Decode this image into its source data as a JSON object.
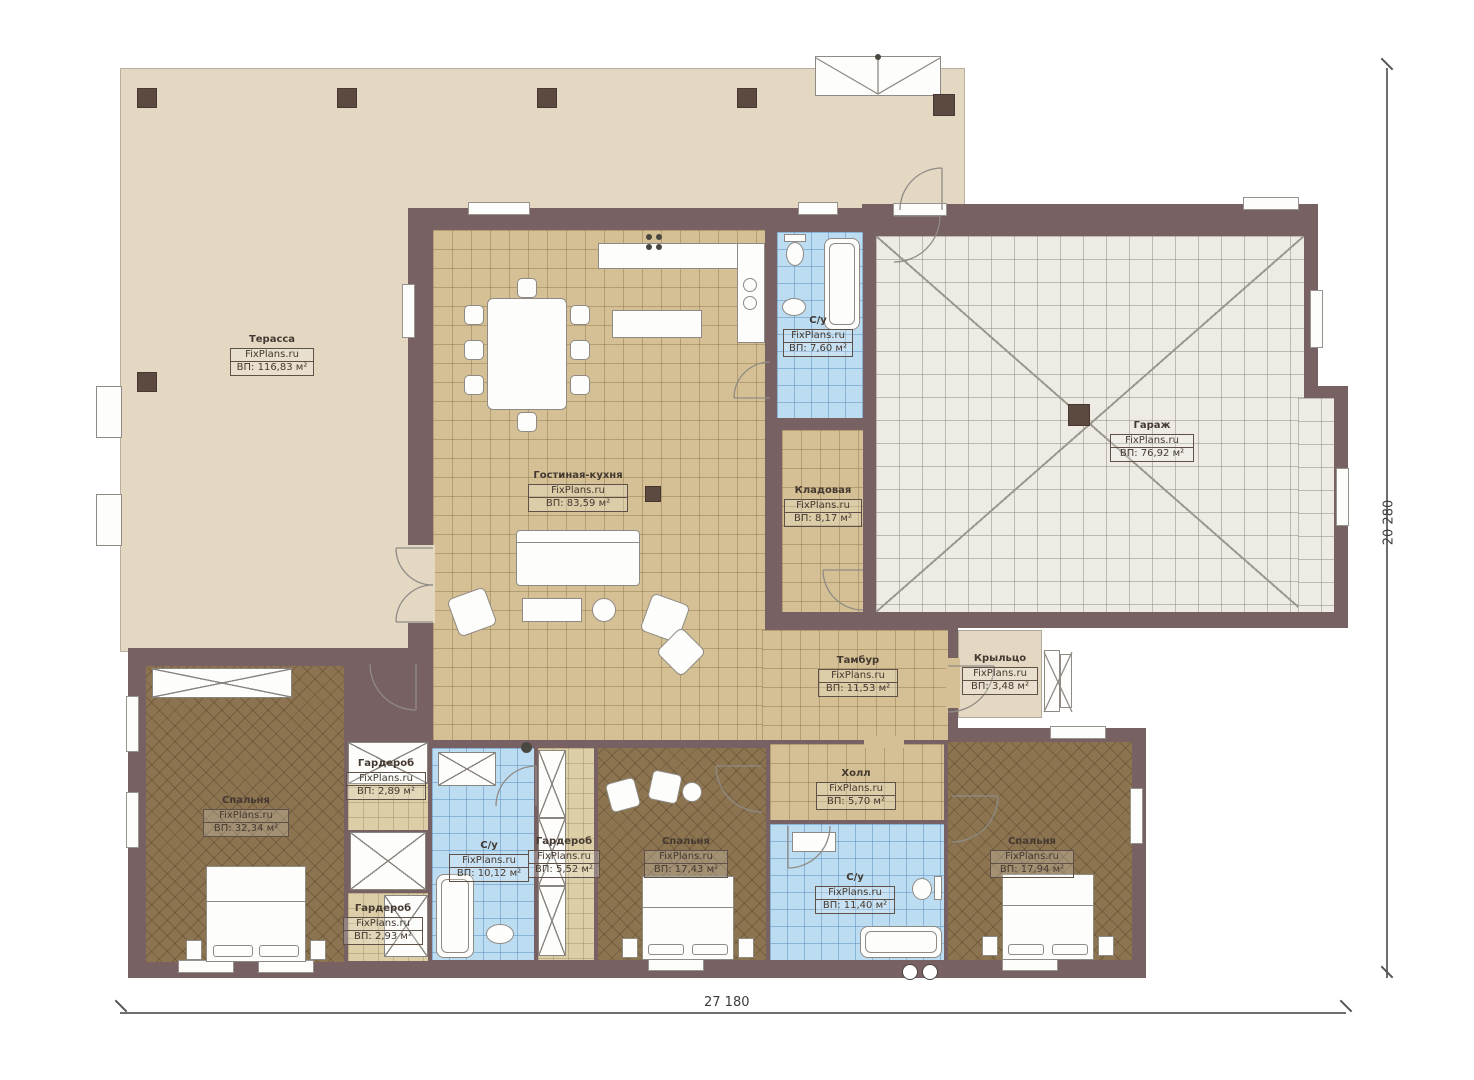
{
  "meta": {
    "site": "FixPlans.ru"
  },
  "dimensions": {
    "width": "27 180",
    "height": "20 280"
  },
  "rooms": {
    "terrace": {
      "name": "Терасса",
      "area": "ВП: 116,83 м²"
    },
    "living": {
      "name": "Гостиная-кухня",
      "area": "ВП: 83,59 м²"
    },
    "bath_top": {
      "name": "С/у",
      "area": "ВП: 7,60 м²"
    },
    "storage": {
      "name": "Кладовая",
      "area": "ВП: 8,17 м²"
    },
    "garage": {
      "name": "Гараж",
      "area": "ВП: 76,92 м²"
    },
    "tambour": {
      "name": "Тамбур",
      "area": "ВП: 11,53 м²"
    },
    "porch": {
      "name": "Крыльцо",
      "area": "ВП: 3,48 м²"
    },
    "bedroom_left": {
      "name": "Спальня",
      "area": "ВП: 32,34 м²"
    },
    "wardrobe_top": {
      "name": "Гардероб",
      "area": "ВП: 2,89 м²"
    },
    "wardrobe_bottom": {
      "name": "Гардероб",
      "area": "ВП: 2,93 м²"
    },
    "bath_left": {
      "name": "С/у",
      "area": "ВП: 10,12 м²"
    },
    "wardrobe_mid": {
      "name": "Гардероб",
      "area": "ВП: 5,52 м²"
    },
    "bedroom_mid": {
      "name": "Спальня",
      "area": "ВП: 17,43 м²"
    },
    "hall": {
      "name": "Холл",
      "area": "ВП: 5,70 м²"
    },
    "bath_mid": {
      "name": "С/у",
      "area": "ВП: 11,40 м²"
    },
    "bedroom_right": {
      "name": "Спальня",
      "area": "ВП: 17,94 м²"
    }
  },
  "colors": {
    "wall": "#786163",
    "terrace": "#e4d8c3",
    "tile": "#d4c094",
    "bedroom": "#8c7450",
    "bath": "#bcdcf2",
    "garage": "#edebe4"
  }
}
